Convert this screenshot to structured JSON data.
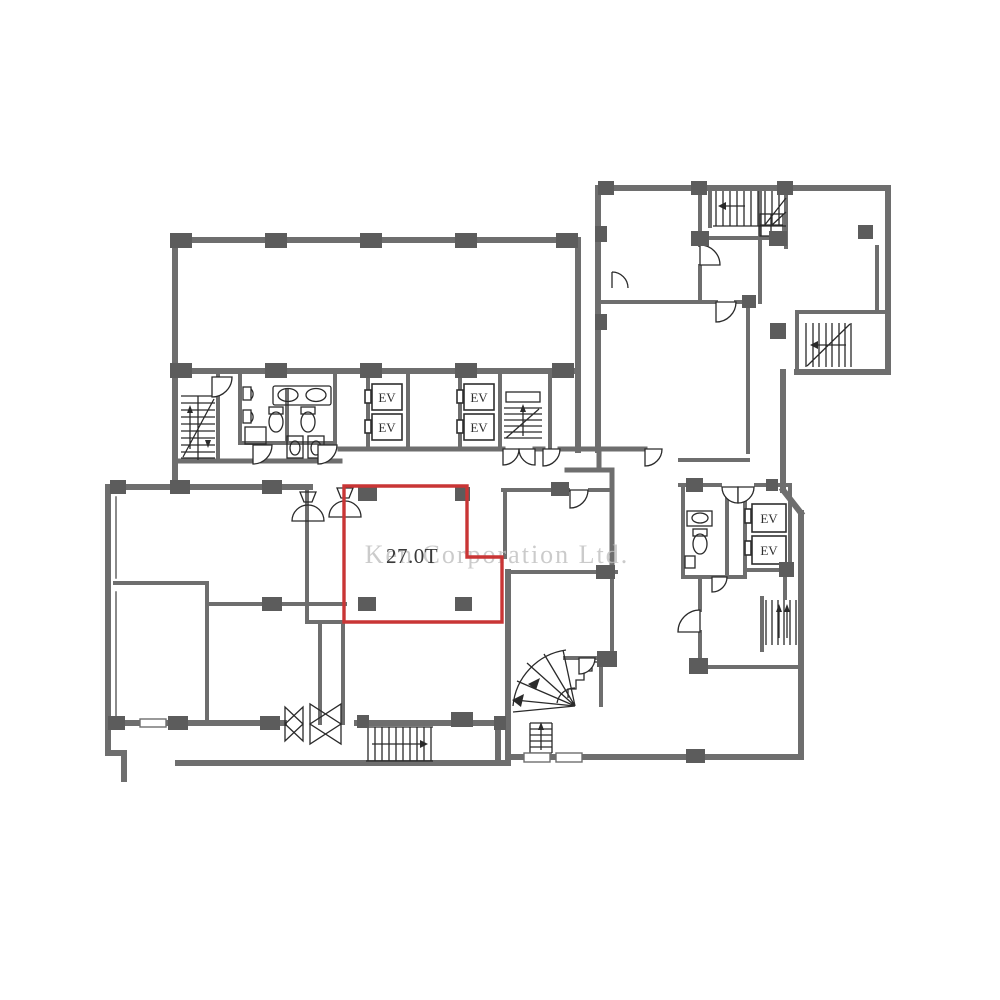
{
  "plan": {
    "unit_area_label": "27.0T",
    "elevator_label": "EV",
    "watermark": "Ken Corporation Ltd."
  },
  "colors": {
    "wall": "#6e6e6e",
    "column": "#5c5c5c",
    "line_detail": "#2a2a2a",
    "highlight_red": "#c93535",
    "watermark_gray": "#bfbfbf",
    "label_text": "#3a3a3a",
    "background": "#ffffff"
  }
}
